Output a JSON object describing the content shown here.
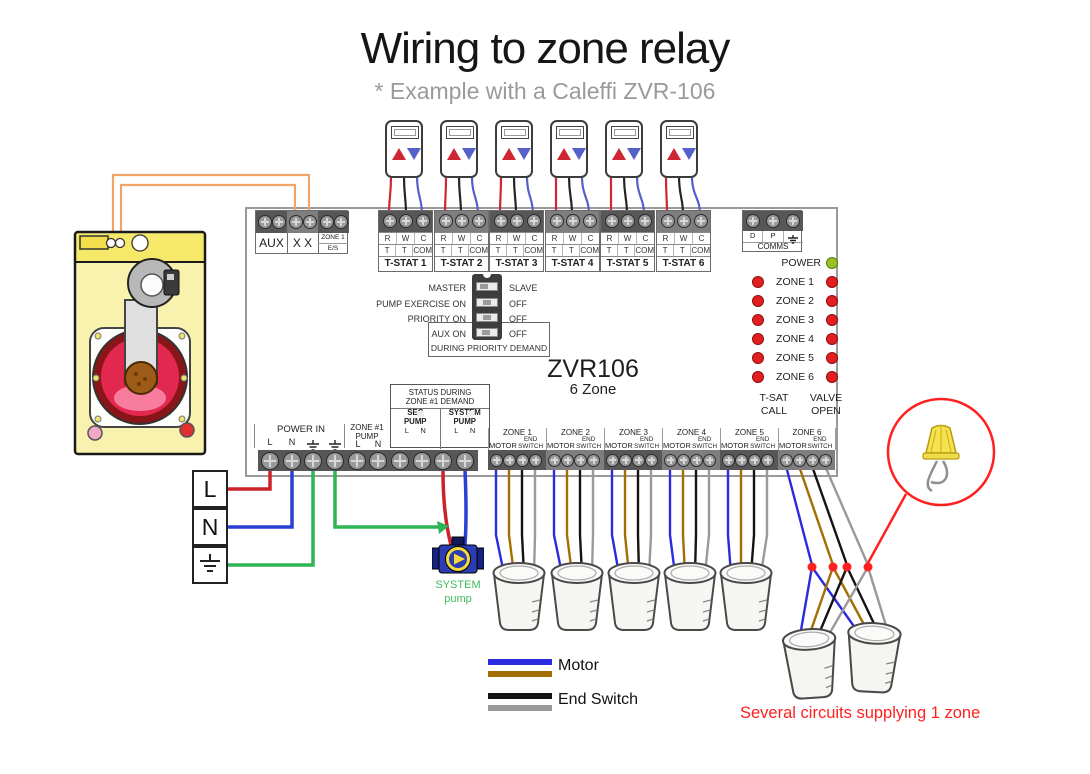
{
  "title": "Wiring to zone relay",
  "subtitle": "* Example with a Caleffi ZVR-106",
  "colors": {
    "live_red": "#cc2229",
    "neutral_blue": "#2a3fd4",
    "earth_green": "#2fb457",
    "aux_orange": "#f0a468",
    "motor_blue": "#2a2ae0",
    "motor_brown": "#a26f00",
    "end_switch_black": "#141414",
    "end_switch_gray": "#9a9a9a",
    "tstat_red": "#cf2633",
    "tstat_black": "#252525",
    "tstat_blue": "#5560c8",
    "led_red": "#e31e1e",
    "led_green": "#96c11e",
    "callout_red": "#ff2020"
  },
  "relay": {
    "model": "ZVR106",
    "model_sub": "6 Zone",
    "aux": {
      "cell1": "AUX",
      "cell2": "X X",
      "cell3_top": "ZONE 1",
      "cell3_bottom": "E/S"
    },
    "comms": {
      "t1": "D",
      "t2": "P",
      "label": "COMMS"
    },
    "dip": {
      "rows": [
        {
          "left": "MASTER",
          "right": "SLAVE"
        },
        {
          "left": "PUMP EXERCISE ON",
          "right": "OFF"
        },
        {
          "left": "PRIORITY ON",
          "right": "OFF"
        },
        {
          "left": "AUX ON",
          "right": "OFF"
        }
      ],
      "note": "DURING PRIORITY DEMAND"
    },
    "leds": {
      "power": "POWER",
      "zones": [
        "ZONE 1",
        "ZONE 2",
        "ZONE 3",
        "ZONE 4",
        "ZONE 5",
        "ZONE 6"
      ],
      "left_caption_1": "T-SAT",
      "left_caption_2": "CALL",
      "right_caption_1": "VALVE",
      "right_caption_2": "OPEN"
    },
    "status": {
      "line1": "STATUS DURING",
      "line2": "ZONE #1 DEMAND",
      "sec1": "SEC",
      "sec2": "PUMP",
      "sys1": "SYSTEM",
      "sys2": "PUMP"
    },
    "tstat_strip": {
      "row1": [
        "R",
        "W",
        "C"
      ],
      "row2": [
        "T",
        "T",
        "COM"
      ],
      "names": [
        "T-STAT 1",
        "T-STAT 2",
        "T-STAT 3",
        "T-STAT 4",
        "T-STAT 5",
        "T-STAT 6"
      ]
    },
    "power_strip": {
      "group1": "POWER IN",
      "group2a": "ZONE #1",
      "group2b": "PUMP",
      "l": "L",
      "n": "N"
    },
    "zone_strip": {
      "names": [
        "ZONE 1",
        "ZONE 2",
        "ZONE 3",
        "ZONE 4",
        "ZONE 5",
        "ZONE 6"
      ],
      "motor": "MOTOR",
      "end1": "END",
      "end2": "SWITCH"
    }
  },
  "supply": {
    "live": "L",
    "neutral": "N"
  },
  "pump": {
    "line1": "SYSTEM",
    "line2": "pump"
  },
  "legend": {
    "motor": "Motor",
    "end_switch": "End Switch"
  },
  "note": "Several circuits supplying 1 zone"
}
